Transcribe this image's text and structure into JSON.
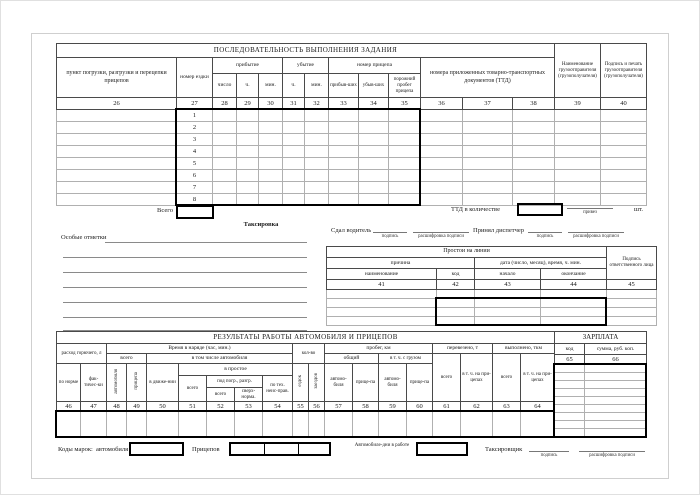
{
  "top_table": {
    "title": "ПОСЛЕДОВАТЕЛЬНОСТЬ ВЫПОЛНЕНИЯ ЗАДАНИЯ",
    "col26": "пункт погрузки, разгрузки и перецепки прицепов",
    "col27": "номер ездки",
    "arrival": "прибытие",
    "arrival_sub": [
      "число",
      "ч.",
      "мин."
    ],
    "departure": "убытие",
    "departure_sub": [
      "ч.",
      "мин."
    ],
    "trailer": "номер прицепа",
    "trailer_sub": [
      "прибыв-ших",
      "убыв-ших",
      "порожний пробег прицепа"
    ],
    "ttd": "номера приложенных товарно-транспортных документов (ТТД)",
    "col39": "Наименование грузоотправителя (грузополучателя)",
    "col40": "Подпись и печать грузоотправителя (грузополучателя)",
    "numbers": [
      "26",
      "27",
      "28",
      "29",
      "30",
      "31",
      "32",
      "33",
      "34",
      "35",
      "36",
      "37",
      "38",
      "39",
      "40"
    ],
    "rows": [
      "1",
      "2",
      "3",
      "4",
      "5",
      "6",
      "7",
      "8"
    ],
    "total": "Всего"
  },
  "notes": {
    "special": "Особые отметки",
    "taksirovka": "Таксировка",
    "ttd_count": "ТТД в количестве",
    "brought": "привез",
    "pcs": "шт."
  },
  "signoff": {
    "driver": "Сдал водитель",
    "dispatcher": "Принял диспетчер",
    "sig": "подпись",
    "sig_decode": "расшифровка подписи"
  },
  "downtime": {
    "title": "Простои на линии",
    "reason": "причина",
    "date": "дата (число, месяц), время, ч. мин.",
    "name": "наименование",
    "code": "код",
    "start": "начало",
    "end": "окончание",
    "sign": "Подпись ответственного лица",
    "numbers": [
      "41",
      "42",
      "43",
      "44",
      "45"
    ]
  },
  "results": {
    "title": "РЕЗУЛЬТАТЫ РАБОТЫ АВТОМОБИЛЯ И ПРИЦЕПОВ",
    "fuel": "расход горючего, л",
    "fuel_norm": "по норме",
    "fuel_fact": "фак-тичес-ки",
    "time_title": "Время в наряде (час, мин.)",
    "total": "всего",
    "vehicle_vert": "автомобиля",
    "trailer_vert": "прицепа",
    "incl_vehicle": "в том числе автомобиля",
    "in_motion": "в движе-нии",
    "idle": "в простое",
    "idle_total": "всего",
    "loading": "под погр., разгр.",
    "loading_total": "всего",
    "over_norm": "сверх-норма.",
    "tech_fault": "по тех. неис-прав.",
    "qty": "кол-во",
    "rides_vert": "ездок",
    "visits_vert": "заездов",
    "mileage": "пробег, км",
    "overall": "общий",
    "with_cargo": "в т. ч. с грузом",
    "vehicle": "автомо-биля",
    "trailer": "прице-па",
    "carried": "перевезено, т",
    "carried_total": "всего",
    "on_trailers": "в т. ч. на при-цепах",
    "done": "выполнено, ткм",
    "done_total": "всего",
    "done_on_trailers": "в т. ч. на при-цепах",
    "numbers": [
      "46",
      "47",
      "48",
      "49",
      "50",
      "51",
      "52",
      "53",
      "54",
      "55",
      "56",
      "57",
      "58",
      "59",
      "60",
      "61",
      "62",
      "63",
      "64"
    ]
  },
  "salary": {
    "title": "ЗАРПЛАТА",
    "code": "код",
    "sum": "сумма, руб. коп.",
    "numbers": [
      "65",
      "66"
    ]
  },
  "footer": {
    "codes": "Коды марок:",
    "vehicle": "автомобиля",
    "trailers": "Прицепов",
    "vehicle_days": "Автомобиле-дни в работе",
    "rater": "Таксировщик",
    "sig": "подпись",
    "sig_decode": "расшифровка подписи"
  }
}
